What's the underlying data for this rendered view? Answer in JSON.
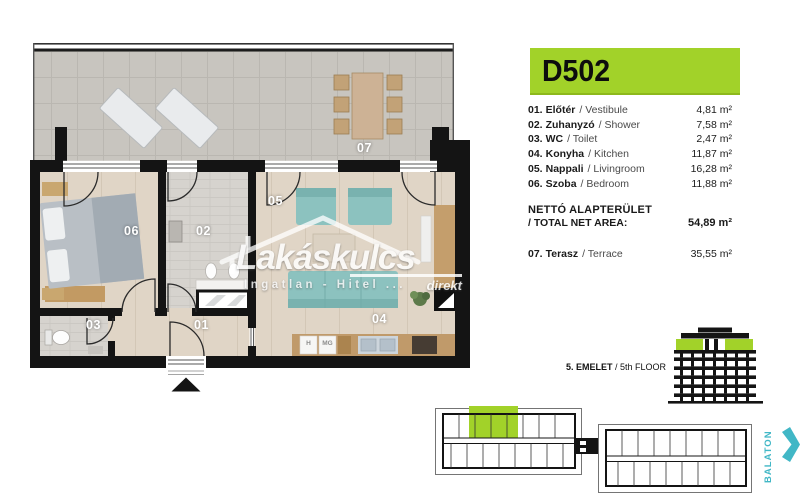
{
  "unit_id": "D502",
  "legend": {
    "rooms": [
      {
        "num": "01.",
        "hu": "Előtér",
        "en": "/ Vestibule",
        "area": "4,81 m²"
      },
      {
        "num": "02.",
        "hu": "Zuhanyzó",
        "en": "/ Shower",
        "area": "7,58 m²"
      },
      {
        "num": "03.",
        "hu": "WC",
        "en": "/ Toilet",
        "area": "2,47 m²"
      },
      {
        "num": "04.",
        "hu": "Konyha",
        "en": "/ Kitchen",
        "area": "11,87 m²"
      },
      {
        "num": "05.",
        "hu": "Nappali",
        "en": "/ Livingroom",
        "area": "16,28 m²"
      },
      {
        "num": "06.",
        "hu": "Szoba",
        "en": "/ Bedroom",
        "area": "11,88 m²"
      }
    ],
    "total": {
      "line1": "NETTÓ ALAPTERÜLET",
      "line2": "/ TOTAL NET AREA:",
      "area": "54,89 m²"
    },
    "terrace_row": {
      "num": "07.",
      "hu": "Terasz",
      "en": "/ Terrace",
      "area": "35,55 m²"
    }
  },
  "plan_labels": {
    "n01": "01",
    "n02": "02",
    "n03": "03",
    "n04": "04",
    "n05": "05",
    "n06": "06",
    "n07": "07"
  },
  "kitchen": {
    "fridge": "H",
    "dishwasher": "MG"
  },
  "floor_indicator": {
    "bold": "5. EMELET",
    "rest": " / 5th FLOOR"
  },
  "direction": {
    "label": "BALATON"
  },
  "watermark": {
    "brand": "Lakáskulcs",
    "sub": "direkt",
    "tagline": "Ingatlan - Hitel ..."
  },
  "colors": {
    "accent_green": "#a2d229",
    "direction_teal": "#41b7c6",
    "sofa_teal": "#8cc2bf"
  }
}
